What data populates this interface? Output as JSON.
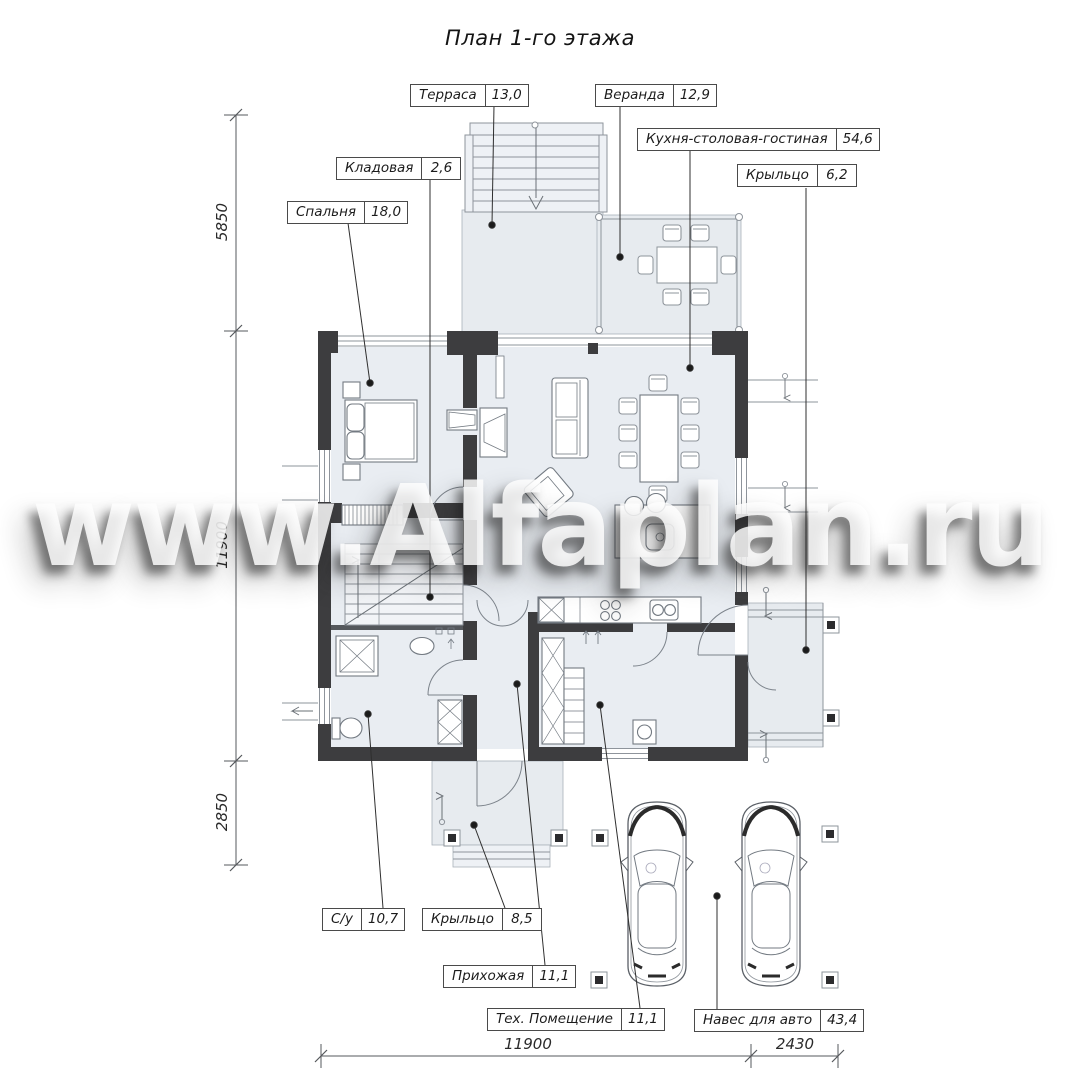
{
  "title": "План 1-го этажа",
  "watermark": "www.Alfaplan.ru",
  "rooms": [
    {
      "name": "Терраса",
      "area": "13,0"
    },
    {
      "name": "Веранда",
      "area": "12,9"
    },
    {
      "name": "Кухня-столовая-гостиная",
      "area": "54,6"
    },
    {
      "name": "Крыльцо",
      "area": "6,2"
    },
    {
      "name": "Кладовая",
      "area": "2,6"
    },
    {
      "name": "Спальня",
      "area": "18,0"
    },
    {
      "name": "С/у",
      "area": "10,7"
    },
    {
      "name": "Крыльцо",
      "area": "8,5"
    },
    {
      "name": "Прихожая",
      "area": "11,1"
    },
    {
      "name": "Тех. Помещение",
      "area": "11,1"
    },
    {
      "name": "Навес для авто",
      "area": "43,4"
    }
  ],
  "dimensions": {
    "left": [
      "5850",
      "11900",
      "2850"
    ],
    "bottom": [
      "11900",
      "2430"
    ]
  },
  "colors": {
    "wall": "#3d3d3f",
    "room_fill": "#e9edf2",
    "line": "#8e949b"
  }
}
